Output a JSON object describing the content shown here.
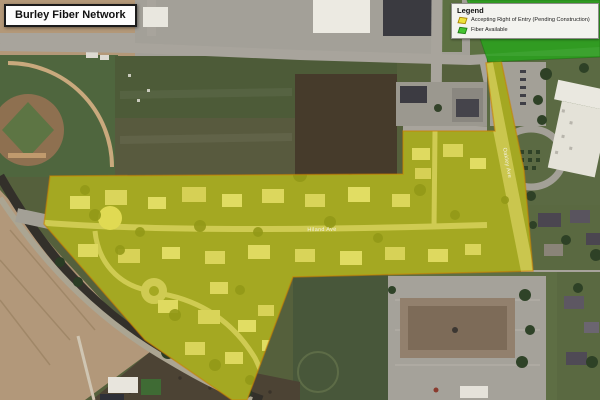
{
  "title": "Burley Fiber Network",
  "legend": {
    "title": "Legend",
    "items": [
      {
        "label": "Accepting Right of Entry (Pending Construction)",
        "swatch_color": "#ede23a",
        "swatch_border": "#a98500"
      },
      {
        "label": "Fiber Available",
        "swatch_color": "#44c431",
        "swatch_border": "#1f7a12"
      }
    ]
  },
  "map": {
    "street_labels": [
      {
        "name": "Hiland Ave"
      },
      {
        "name": "Oakley Ave"
      }
    ],
    "overlays": {
      "accepting_right_of_entry": {
        "fill": "rgba(233,230,0,0.5)",
        "stroke": "rgba(206,128,0,0.55)"
      },
      "fiber_available": {
        "fill": "rgba(41,162,28,0.85)"
      }
    }
  }
}
